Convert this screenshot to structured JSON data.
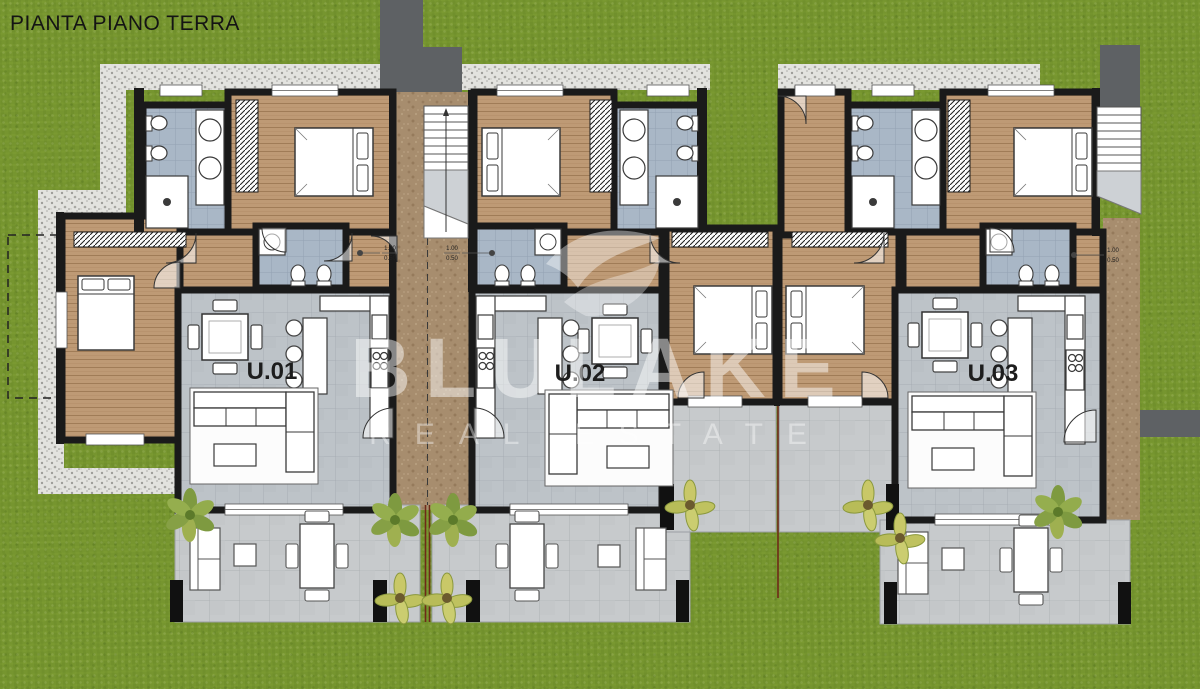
{
  "title": "PIANTA PIANO TERRA",
  "watermark": {
    "brand": "BLULAKE",
    "tagline": "REAL ESTATE"
  },
  "units": [
    {
      "label": "U.01"
    },
    {
      "label": "U.02"
    },
    {
      "label": "U.03"
    }
  ],
  "dimension_markers": [
    {
      "top": "1.00",
      "bottom": "0.50"
    },
    {
      "top": "1.00",
      "bottom": "0.50"
    },
    {
      "top": "1.00",
      "bottom": "0.50"
    }
  ],
  "colors": {
    "grass": "#76952F",
    "wall": "#1A1A1A",
    "wood_floor": "#BE9A75",
    "tile_floor": "#BDC3C8",
    "bath_floor": "#A9B7C6",
    "terrace": "#C7CACC",
    "path": "#A78D6E",
    "walkway": "#5E6164",
    "gravel": "#E3E3DF",
    "watermark": "#FFFFFF"
  }
}
